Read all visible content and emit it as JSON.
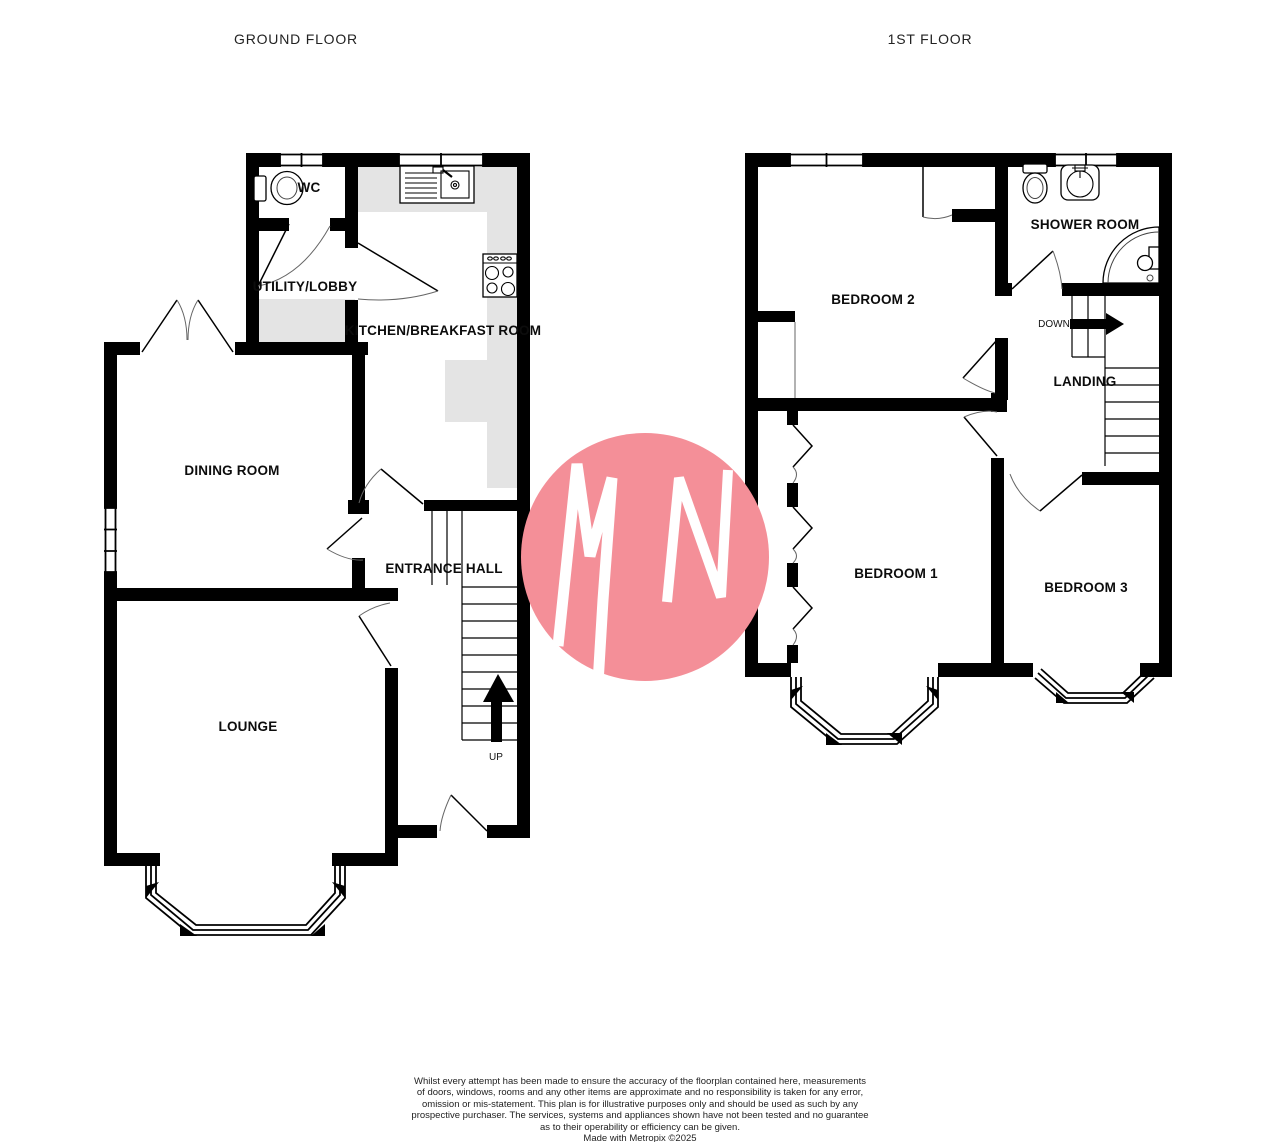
{
  "ground": {
    "title": "GROUND FLOOR",
    "wc_label": "WC",
    "utility_label": "UTILITY/LOBBY",
    "kitchen_label": "KITCHEN/BREAKFAST ROOM",
    "dining_label": "DINING ROOM",
    "hall_label": "ENTRANCE HALL",
    "lounge_label": "LOUNGE",
    "stairs_label": "UP"
  },
  "first": {
    "title": "1ST FLOOR",
    "bedroom2_label": "BEDROOM 2",
    "shower_label": "SHOWER ROOM",
    "landing_label": "LANDING",
    "stairs_label": "DOWN",
    "bedroom1_label": "BEDROOM 1",
    "bedroom3_label": "BEDROOM 3"
  },
  "watermark": {
    "letters": "MN",
    "color": "#f48f98"
  },
  "colors": {
    "wall": "#000000",
    "counter": "#e4e4e4",
    "label": "#0c0c0c"
  },
  "footer": {
    "lines": [
      "Whilst every attempt has been made to ensure the accuracy of the floorplan contained here, measurements",
      "of doors, windows, rooms and any other items are approximate and no responsibility is taken for any error,",
      "omission or mis-statement. This plan is for illustrative purposes only and should be used as such by any",
      "prospective purchaser. The services, systems and appliances shown have not been tested and no guarantee",
      "as to their operability or efficiency can be given."
    ],
    "credit": "Made with Metropix ©2025"
  }
}
